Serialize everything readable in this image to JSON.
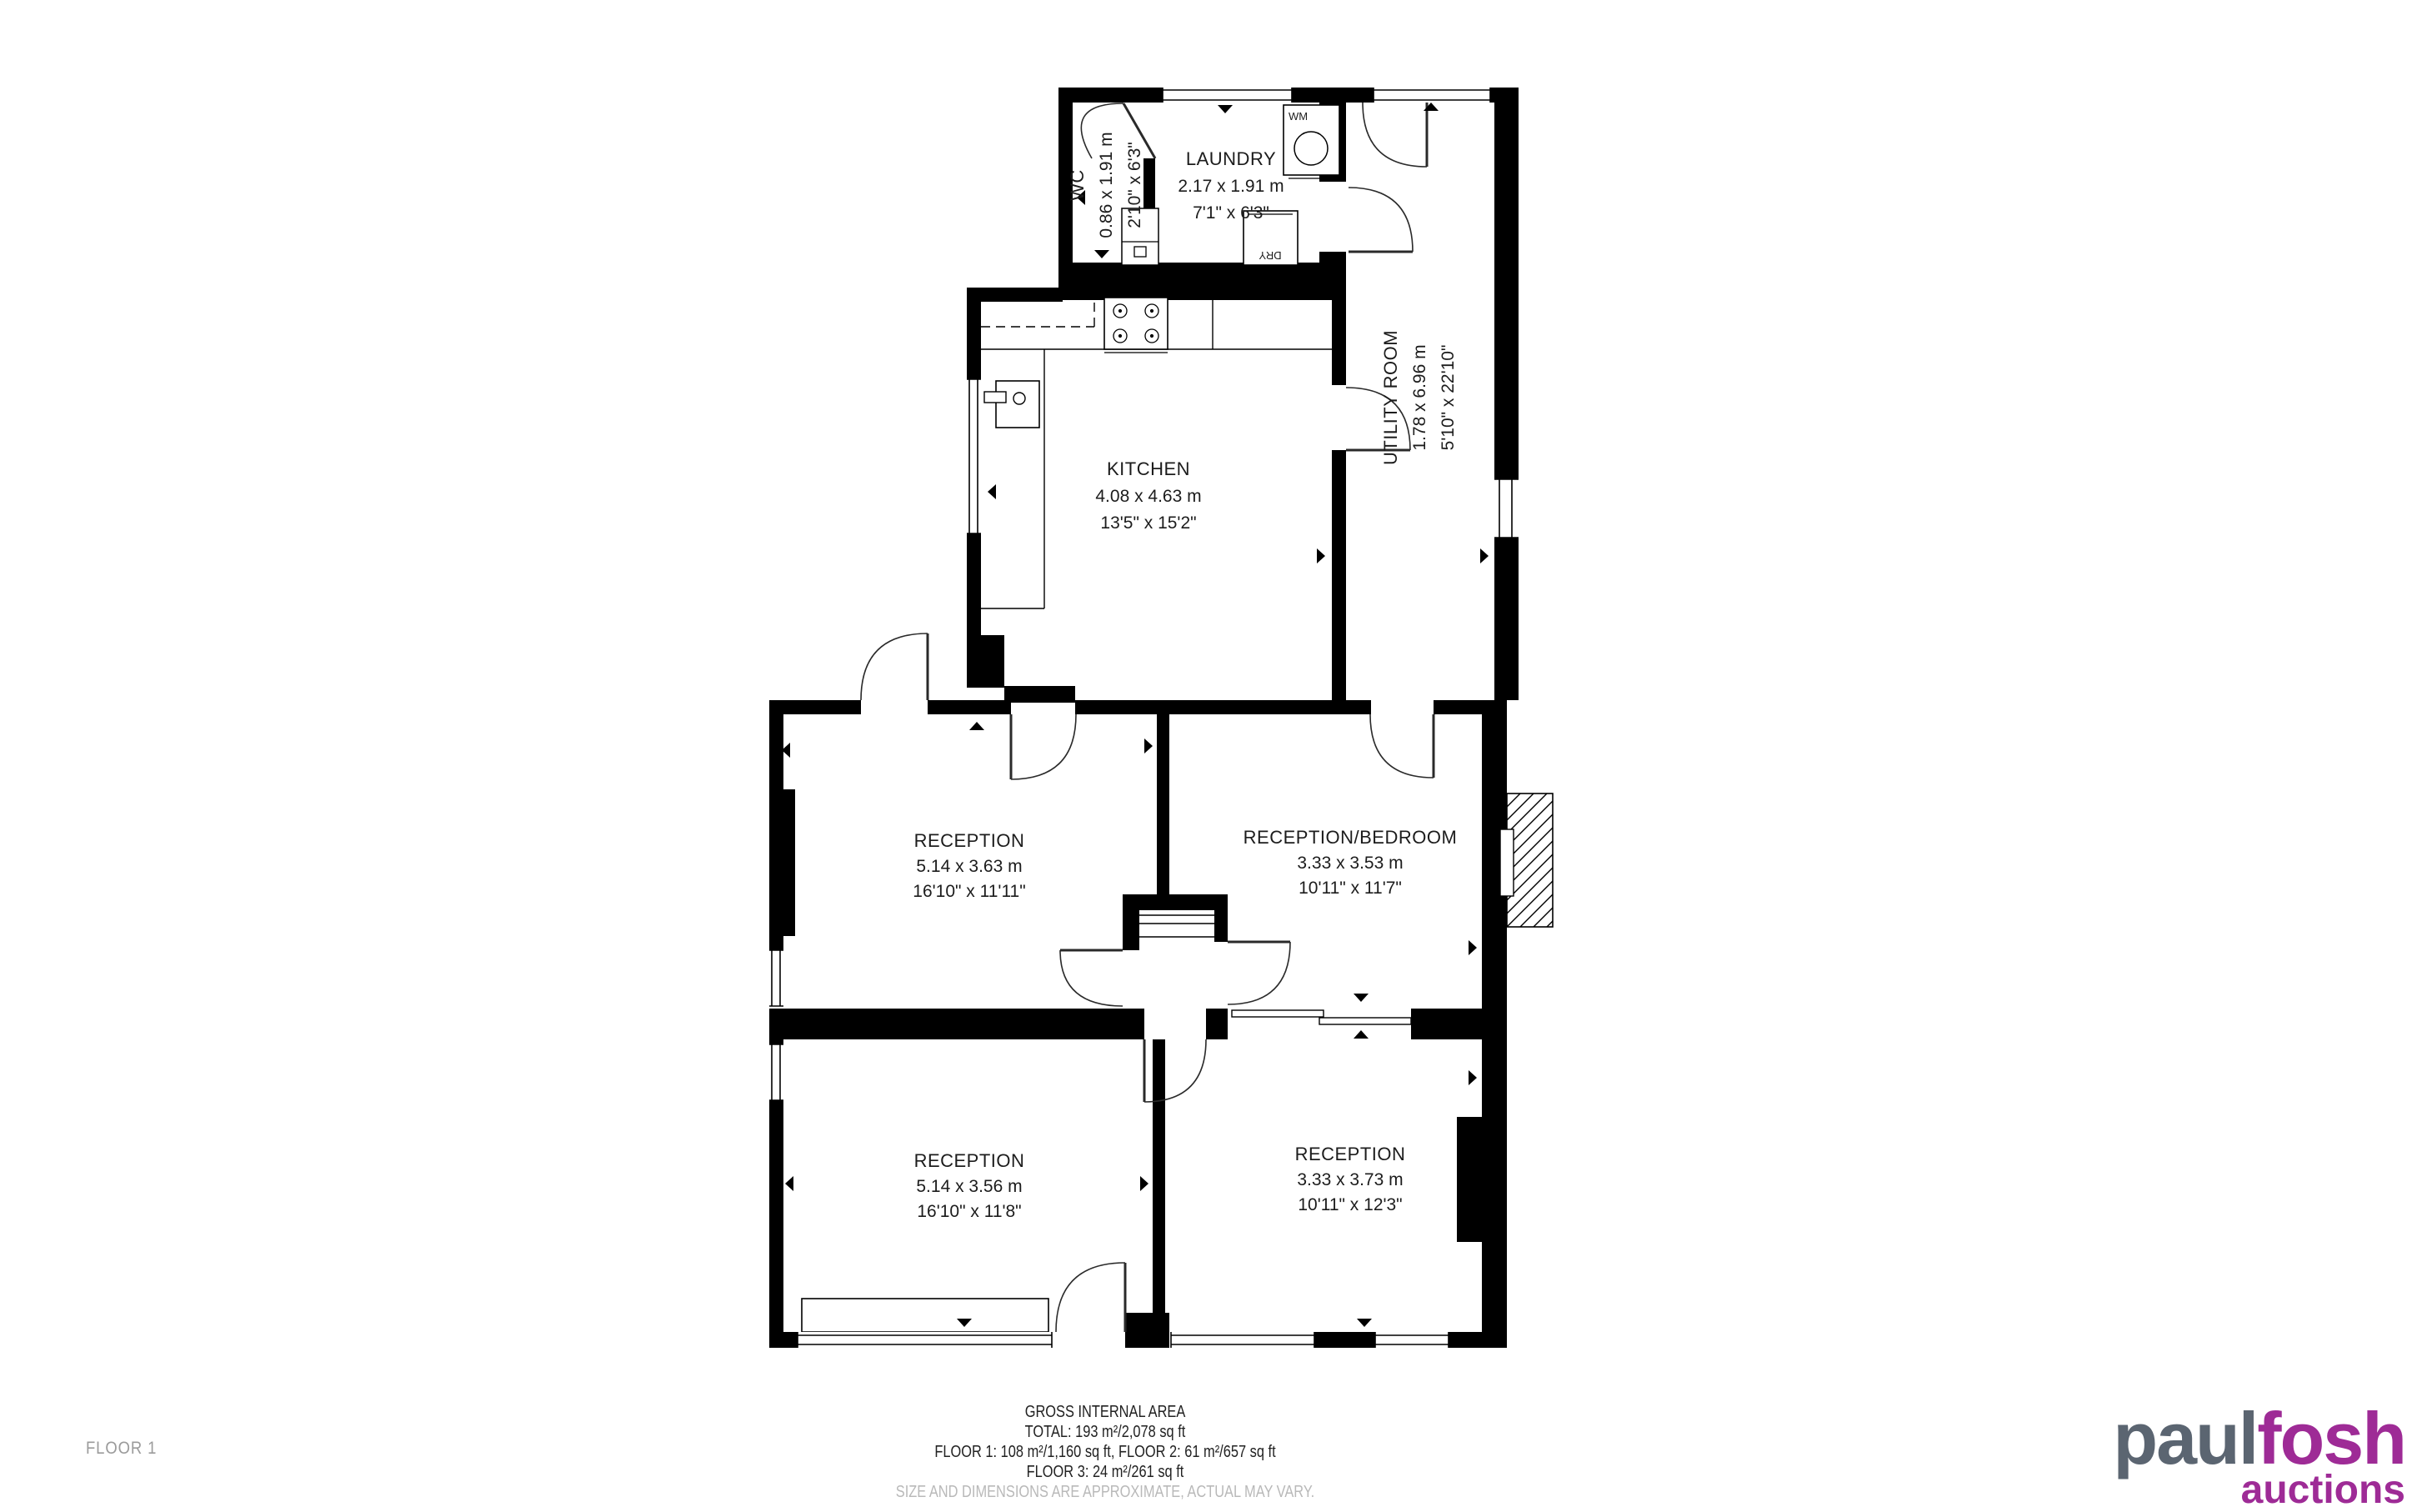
{
  "floor_label": "FLOOR 1",
  "rooms": {
    "wc": {
      "name": "WC",
      "metric": "0.86 x 1.91 m",
      "imperial": "2'10\" x 6'3\""
    },
    "laundry": {
      "name": "LAUNDRY",
      "metric": "2.17 x 1.91 m",
      "imperial": "7'1\" x 6'3\""
    },
    "utility": {
      "name": "UTILITY ROOM",
      "metric": "1.78 x 6.96 m",
      "imperial": "5'10\" x 22'10\""
    },
    "kitchen": {
      "name": "KITCHEN",
      "metric": "4.08 x 4.63 m",
      "imperial": "13'5\" x 15'2\""
    },
    "reception_mid": {
      "name": "RECEPTION",
      "metric": "5.14 x 3.63 m",
      "imperial": "16'10\" x 11'11\""
    },
    "reception_bed": {
      "name": "RECEPTION/BEDROOM",
      "metric": "3.33 x 3.53 m",
      "imperial": "10'11\" x 11'7\""
    },
    "reception_bl": {
      "name": "RECEPTION",
      "metric": "5.14 x 3.56 m",
      "imperial": "16'10\" x 11'8\""
    },
    "reception_br": {
      "name": "RECEPTION",
      "metric": "3.33 x 3.73 m",
      "imperial": "10'11\" x 12'3\""
    }
  },
  "appliances": {
    "washing_machine": "WM",
    "dryer": "DRY"
  },
  "footer": {
    "title": "GROSS INTERNAL AREA",
    "total": "TOTAL: 193 m²/2,078 sq ft",
    "floors_1_2": "FLOOR 1: 108 m²/1,160 sq ft, FLOOR 2: 61 m²/657 sq ft",
    "floor_3": "FLOOR 3: 24 m²/261 sq ft",
    "disclaimer": "SIZE AND DIMENSIONS ARE APPROXIMATE, ACTUAL MAY VARY."
  },
  "logo": {
    "part1": "paul",
    "part2": "fosh",
    "part3": "auctions"
  },
  "colors": {
    "wall": "#000000",
    "logo_gray": "#5b6571",
    "logo_purple": "#9e2b96",
    "muted_gray": "#9b9b9b",
    "disclaimer_gray": "#b9b9b9"
  }
}
